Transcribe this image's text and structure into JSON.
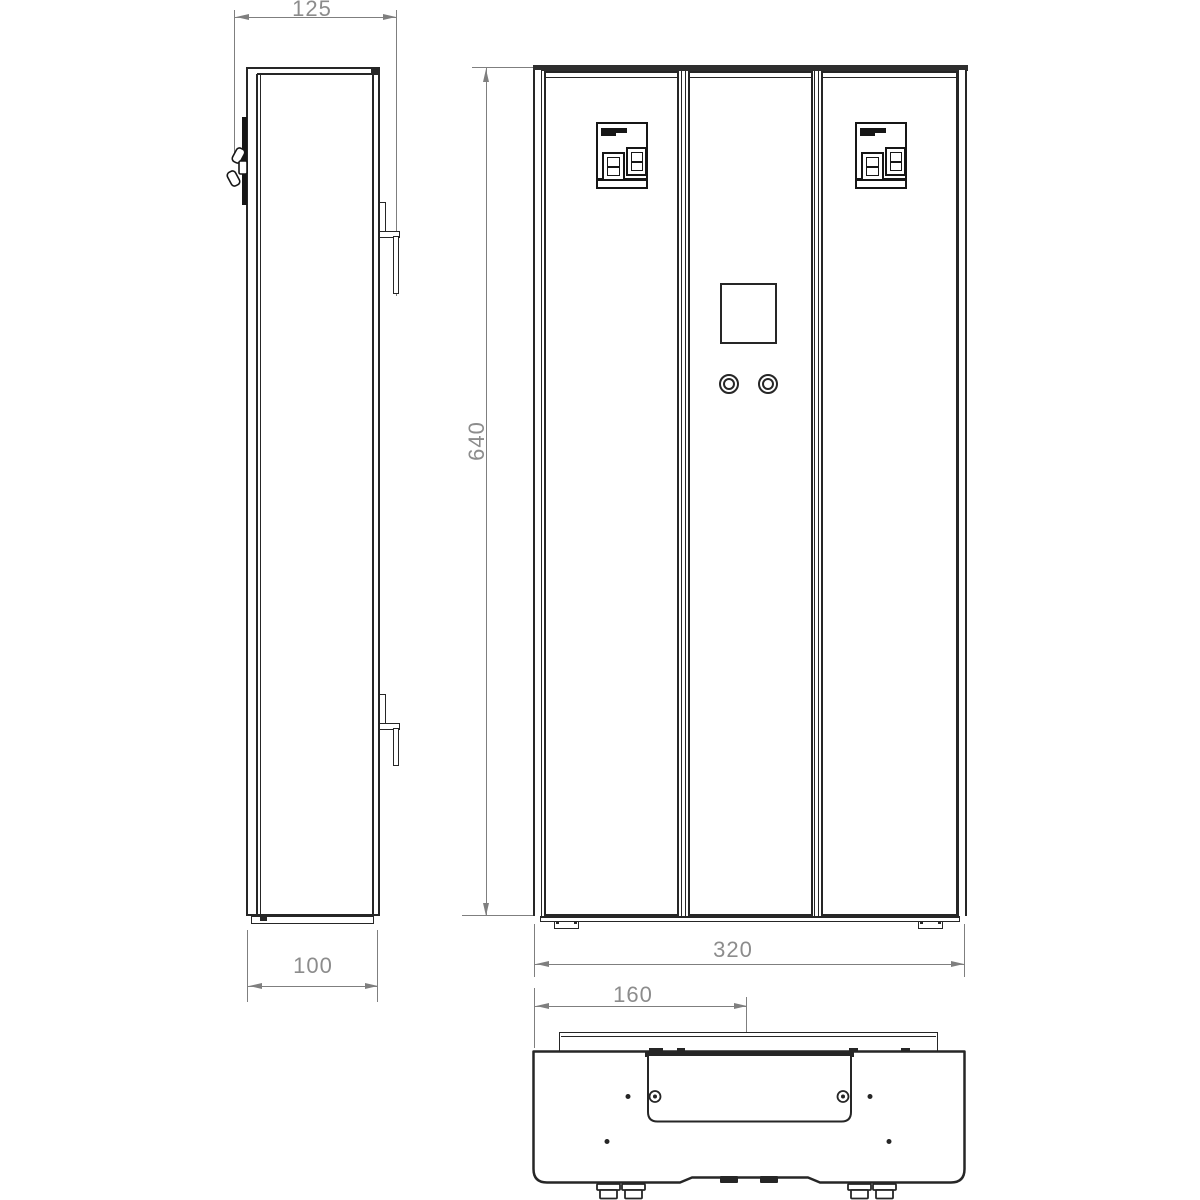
{
  "drawing": {
    "background_color": "#ffffff",
    "line_color": "#262626",
    "dimension_line_color": "#7f7f7f",
    "dimension_text_color": "#8c8c8c"
  },
  "dimensions": {
    "overall_depth": "125",
    "body_depth": "100",
    "height": "640",
    "width": "320",
    "center_offset": "160"
  }
}
